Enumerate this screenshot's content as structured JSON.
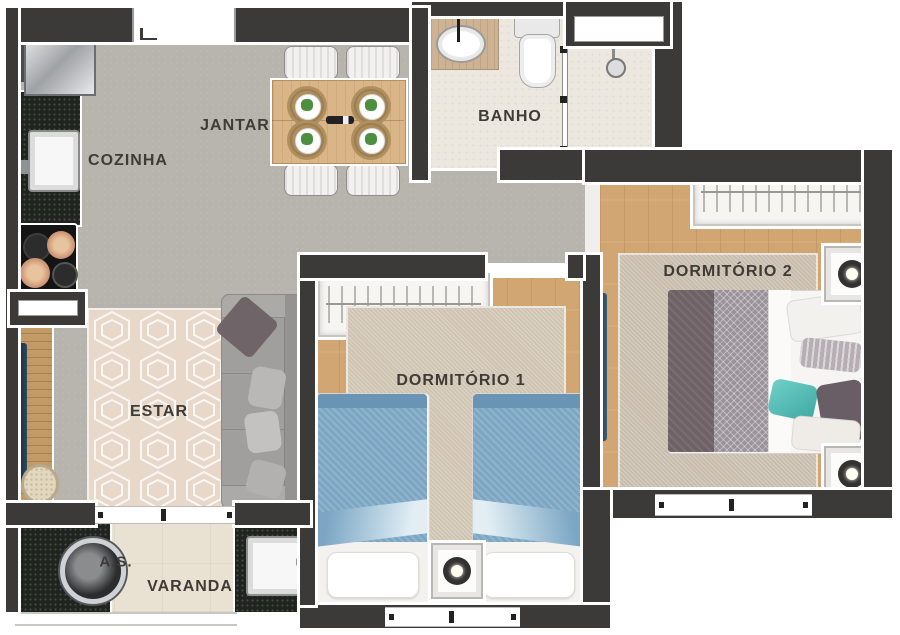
{
  "floor_plan": {
    "type": "apartment-floor-plan-top-view",
    "rooms": [
      {
        "id": "cozinha",
        "label": "COZINHA"
      },
      {
        "id": "jantar",
        "label": "JANTAR"
      },
      {
        "id": "banho",
        "label": "BANHO"
      },
      {
        "id": "estar",
        "label": "ESTAR"
      },
      {
        "id": "dormitorio1",
        "label": "DORMITÓRIO 1"
      },
      {
        "id": "dormitorio2",
        "label": "DORMITÓRIO 2"
      },
      {
        "id": "area_servico",
        "label": "A.S."
      },
      {
        "id": "varanda",
        "label": "VARANDA"
      }
    ],
    "colors": {
      "wall": "#3b3a38",
      "background": "#ffffff",
      "social_floor_gray": "#b7b4ae",
      "bathroom_stone": "#ece7df",
      "bedroom_wood": "#d2a672",
      "balcony_cream": "#e9e1d1",
      "granite_counter": "#20241f",
      "single_bed_blue": "#7ca6c4",
      "double_bed_gray_purple": "#6e6266",
      "teal_accent_pillow": "#57c0b8",
      "sofa_gray": "#a09f9d",
      "door_leaf_teal": "#2c4353",
      "label_text": "#3f3b37"
    }
  }
}
